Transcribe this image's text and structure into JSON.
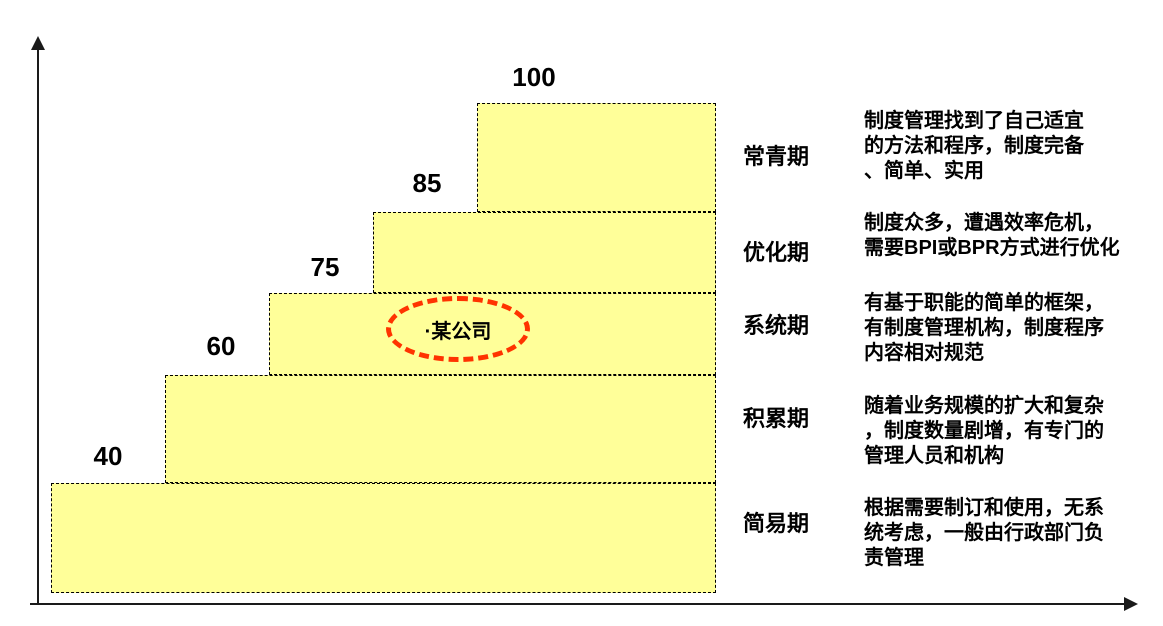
{
  "chart_data": {
    "type": "bar",
    "subtype": "staircase-maturity-steps",
    "categories": [
      "简易期",
      "积累期",
      "系统期",
      "优化期",
      "常青期"
    ],
    "values": [
      40,
      60,
      75,
      85,
      100
    ],
    "title": "",
    "xlabel": "",
    "ylabel": "",
    "ylim": [
      0,
      100
    ],
    "grid": false,
    "legend": false,
    "bar_fill": "#FFFF99",
    "bar_border_style": "dashed",
    "annotations": [
      {
        "text": "·某公司",
        "attached_to": "系统期",
        "style": "red-dashed-ellipse"
      }
    ]
  },
  "stages": [
    {
      "name": "常青期",
      "value": 100,
      "description": "制度管理找到了自己适宜\n的方法和程序，制度完备\n、简单、实用"
    },
    {
      "name": "优化期",
      "value": 85,
      "description": "制度众多，遭遇效率危机，\n需要BPI或BPR方式进行优化"
    },
    {
      "name": "系统期",
      "value": 75,
      "description": "有基于职能的简单的框架，\n有制度管理机构，制度程序\n内容相对规范"
    },
    {
      "name": "积累期",
      "value": 60,
      "description": "随着业务规模的扩大和复杂\n，制度数量剧增，有专门的\n管理人员和机构"
    },
    {
      "name": "简易期",
      "value": 40,
      "description": "根据需要制订和使用，无系\n统考虑，一般由行政部门负\n责管理"
    }
  ],
  "annotation": {
    "label": "·某公司"
  },
  "colors": {
    "bar_fill": "#FFFF99",
    "bar_border": "#000000",
    "annotation_red": "#FF3300",
    "text": "#000000",
    "axis": "#1a1a1a"
  }
}
